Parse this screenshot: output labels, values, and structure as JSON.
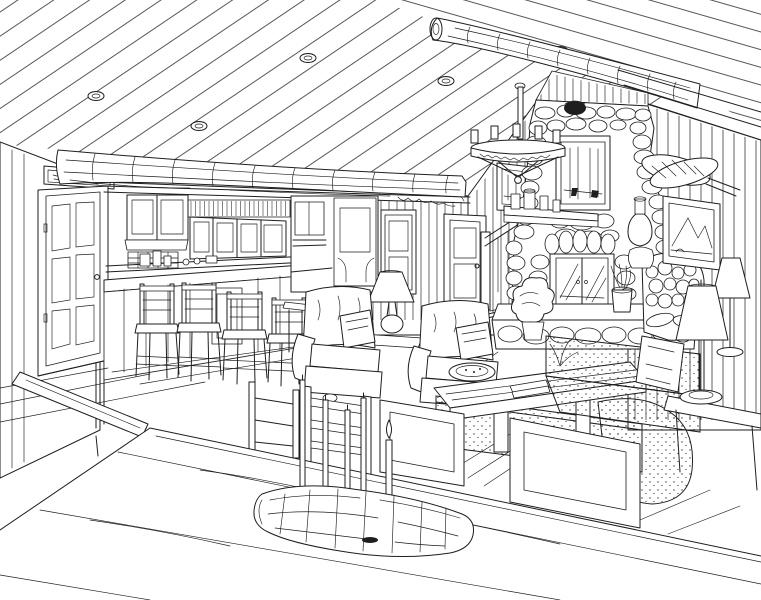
{
  "meta": {
    "title": "Log cabin great room — black-and-white pen-and-ink interior rendering",
    "medium": "hand-drawn line illustration, black ink on white paper",
    "view": "one-point/two-point perspective from behind a large plank dining table"
  },
  "palette": {
    "ink": "#1e1e1e",
    "paper": "#ffffff"
  },
  "sign_above_door": {
    "present": true,
    "text_legible": false,
    "style": "small hand-lettered wooden plaque"
  },
  "scene": {
    "areas": [
      "vaulted plank ceiling",
      "kitchen with bar",
      "living room",
      "stone fireplace wall",
      "foreground dining table"
    ],
    "objects": [
      {
        "name": "ceiling-left-plane",
        "label": "sloped tongue-and-groove ceiling with recessed lights"
      },
      {
        "name": "ceiling-right-plane",
        "label": "opposite roof plane above ridge"
      },
      {
        "name": "log-beam",
        "label": "large peeled-log beam spanning the kitchen wall"
      },
      {
        "name": "ridge-log",
        "label": "log ridge beam running to the stone chimney"
      },
      {
        "name": "chandelier",
        "label": "wrought-iron candle chandelier on a drop rod"
      },
      {
        "name": "entry-door",
        "label": "six-panel entry door with plaque above"
      },
      {
        "name": "kitchen-cabinets",
        "label": "upper cabinets, plate rack, tiled backsplash, counter"
      },
      {
        "name": "bar-stools",
        "label": "four ladder-back bar stools at raised bar"
      },
      {
        "name": "hutch",
        "label": "tall built-in hutch cabinet"
      },
      {
        "name": "interior-doors",
        "label": "two paneled interior doors"
      },
      {
        "name": "staircase",
        "label": "stair with handrail rising beside the chimney"
      },
      {
        "name": "stone-chimney",
        "label": "floor-to-ceiling fieldstone fireplace"
      },
      {
        "name": "firebox",
        "label": "glass-door firebox on raised stone hearth"
      },
      {
        "name": "mantel",
        "label": "mantel shelf with jars and crocks"
      },
      {
        "name": "framed-art",
        "label": "three framed landscape pictures"
      },
      {
        "name": "snowshoes",
        "label": "crossed snowshoes hung on gable wall"
      },
      {
        "name": "firewood",
        "label": "stacked firewood beside hearth"
      },
      {
        "name": "armchairs",
        "label": "two upholstered club chairs with throw pillows"
      },
      {
        "name": "table-lamp",
        "label": "table lamp between the club chairs"
      },
      {
        "name": "coffee-table",
        "label": "plank coffee table with bowl, books and branch"
      },
      {
        "name": "sofa",
        "label": "speckled-upholstery sofa with pillows"
      },
      {
        "name": "floor-lamps",
        "label": "two shaded floor lamps"
      },
      {
        "name": "dining-table",
        "label": "massive plank dining table in foreground"
      },
      {
        "name": "dining-chairs",
        "label": "panel-back and ladder-back dining chairs"
      },
      {
        "name": "candle-log",
        "label": "half-log centerpiece holding five taper candles"
      },
      {
        "name": "plants",
        "label": "potted greenery on hearth and floor"
      },
      {
        "name": "wood-floor",
        "label": "wide-plank wood flooring"
      }
    ]
  }
}
